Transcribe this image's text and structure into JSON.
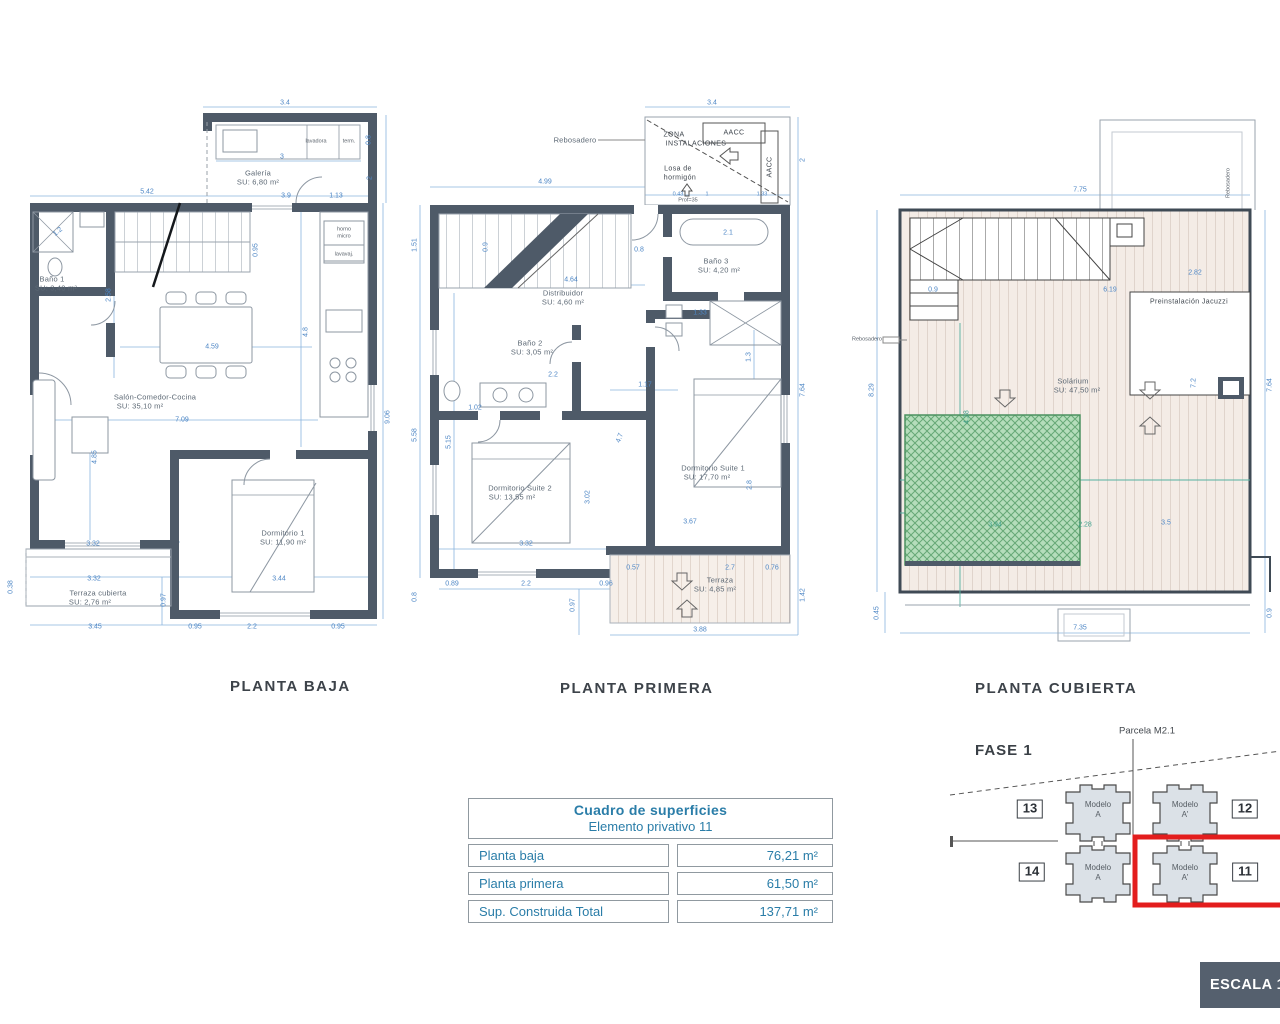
{
  "plans": {
    "baja": {
      "title": "PLANTA BAJA",
      "labels": [
        {
          "t": "3.4",
          "x": 265,
          "y": 8
        },
        {
          "t": "0.8",
          "x": 349,
          "y": 45,
          "r": -90
        },
        {
          "t": "3",
          "x": 262,
          "y": 62
        },
        {
          "t": "5.42",
          "x": 127,
          "y": 97
        },
        {
          "t": "3.9",
          "x": 266,
          "y": 101
        },
        {
          "t": "1.13",
          "x": 316,
          "y": 101
        },
        {
          "t": "2",
          "x": 350,
          "y": 83,
          "r": -90
        },
        {
          "t": "1.2",
          "x": 38,
          "y": 137,
          "r": -40
        },
        {
          "t": "2.58",
          "x": 89,
          "y": 200,
          "r": -90
        },
        {
          "t": "0.95",
          "x": 236,
          "y": 155,
          "r": -90
        },
        {
          "t": "4.8",
          "x": 286,
          "y": 237,
          "r": -90
        },
        {
          "t": "4.59",
          "x": 192,
          "y": 252
        },
        {
          "t": "7.09",
          "x": 162,
          "y": 325
        },
        {
          "t": "9.06",
          "x": 368,
          "y": 322,
          "r": -90
        },
        {
          "t": "4.85",
          "x": 75,
          "y": 362,
          "r": -90
        },
        {
          "t": "3.32",
          "x": 73,
          "y": 449
        },
        {
          "t": "0.38",
          "x": -9,
          "y": 492,
          "r": -90
        },
        {
          "t": "3.32",
          "x": 74,
          "y": 484
        },
        {
          "t": "3.44",
          "x": 259,
          "y": 484
        },
        {
          "t": "0.97",
          "x": 144,
          "y": 505,
          "r": -90
        },
        {
          "t": "3.45",
          "x": 75,
          "y": 532
        },
        {
          "t": "0.95",
          "x": 175,
          "y": 532
        },
        {
          "t": "2.2",
          "x": 232,
          "y": 532
        },
        {
          "t": "0.95",
          "x": 318,
          "y": 532
        },
        {
          "t": "Galería",
          "x": 238,
          "y": 78,
          "c": "room"
        },
        {
          "t": "SU: 6,80 m²",
          "x": 238,
          "y": 87,
          "c": "room"
        },
        {
          "t": "Baño 1",
          "x": 32,
          "y": 184,
          "c": "room"
        },
        {
          "t": "SU: 3,40 m²",
          "x": 36,
          "y": 193,
          "c": "room"
        },
        {
          "t": "Salón-Comedor-Cocina",
          "x": 135,
          "y": 302,
          "c": "room"
        },
        {
          "t": "SU: 35,10 m²",
          "x": 120,
          "y": 311,
          "c": "room"
        },
        {
          "t": "Dormitorio 1",
          "x": 263,
          "y": 438,
          "c": "room"
        },
        {
          "t": "SU: 11,90 m²",
          "x": 263,
          "y": 447,
          "c": "room"
        },
        {
          "t": "Terraza cubierta",
          "x": 78,
          "y": 498,
          "c": "room"
        },
        {
          "t": "SU: 2,76 m²",
          "x": 70,
          "y": 507,
          "c": "room"
        },
        {
          "t": "lavadora",
          "x": 296,
          "y": 47,
          "c": "tiny"
        },
        {
          "t": "term.",
          "x": 329,
          "y": 47,
          "c": "tiny"
        },
        {
          "t": "horno",
          "x": 324,
          "y": 135,
          "c": "tiny"
        },
        {
          "t": "micro",
          "x": 324,
          "y": 142,
          "c": "tiny"
        },
        {
          "t": "lavavaj.",
          "x": 324,
          "y": 160,
          "c": "tiny"
        }
      ]
    },
    "primera": {
      "title": "PLANTA PRIMERA",
      "labels": [
        {
          "t": "3.4",
          "x": 292,
          "y": 8
        },
        {
          "t": "4.99",
          "x": 125,
          "y": 87
        },
        {
          "t": "0.43",
          "x": 258,
          "y": 100,
          "c": "dimt"
        },
        {
          "t": "1",
          "x": 287,
          "y": 100,
          "c": "dimt"
        },
        {
          "t": "1.33",
          "x": 342,
          "y": 100,
          "c": "dimt"
        },
        {
          "t": "2",
          "x": 383,
          "y": 65,
          "r": -90
        },
        {
          "t": "1.51",
          "x": -5,
          "y": 150,
          "r": -90
        },
        {
          "t": "0.9",
          "x": 66,
          "y": 152,
          "r": -90
        },
        {
          "t": "0.8",
          "x": 219,
          "y": 155
        },
        {
          "t": "2.1",
          "x": 308,
          "y": 138
        },
        {
          "t": "4.64",
          "x": 151,
          "y": 185
        },
        {
          "t": "1.33",
          "x": 280,
          "y": 218
        },
        {
          "t": "1.3",
          "x": 329,
          "y": 262,
          "r": -90
        },
        {
          "t": "7.64",
          "x": 383,
          "y": 295,
          "r": -90
        },
        {
          "t": "1.17",
          "x": 225,
          "y": 290
        },
        {
          "t": "1.02",
          "x": 55,
          "y": 313
        },
        {
          "t": "5.58",
          "x": -5,
          "y": 340,
          "r": -90
        },
        {
          "t": "5.15",
          "x": 29,
          "y": 347,
          "r": -90
        },
        {
          "t": "4.7",
          "x": 200,
          "y": 343,
          "r": -70
        },
        {
          "t": "3.02",
          "x": 168,
          "y": 402,
          "r": -90
        },
        {
          "t": "2.8",
          "x": 330,
          "y": 390,
          "r": -90
        },
        {
          "t": "3.67",
          "x": 270,
          "y": 427
        },
        {
          "t": "3.32",
          "x": 106,
          "y": 449
        },
        {
          "t": "0.57",
          "x": 213,
          "y": 473
        },
        {
          "t": "2.7",
          "x": 310,
          "y": 473
        },
        {
          "t": "0.76",
          "x": 352,
          "y": 473
        },
        {
          "t": "0.89",
          "x": 32,
          "y": 489
        },
        {
          "t": "2.2",
          "x": 106,
          "y": 489
        },
        {
          "t": "0.96",
          "x": 186,
          "y": 489
        },
        {
          "t": "0.8",
          "x": -5,
          "y": 502,
          "r": -90
        },
        {
          "t": "0.97",
          "x": 153,
          "y": 510,
          "r": -90
        },
        {
          "t": "3.88",
          "x": 280,
          "y": 535
        },
        {
          "t": "1.42",
          "x": 383,
          "y": 500,
          "r": -90
        },
        {
          "t": "Rebosadero",
          "x": 155,
          "y": 45,
          "c": "room"
        },
        {
          "t": "ZONA",
          "x": 254,
          "y": 40,
          "c": "dark"
        },
        {
          "t": "INSTALACIONES",
          "x": 276,
          "y": 49,
          "c": "dark"
        },
        {
          "t": "AACC",
          "x": 314,
          "y": 38,
          "c": "dark"
        },
        {
          "t": "AACC",
          "x": 350,
          "y": 72,
          "r": -90,
          "c": "dark"
        },
        {
          "t": "Losa de",
          "x": 258,
          "y": 74,
          "c": "dark"
        },
        {
          "t": "hormigón",
          "x": 260,
          "y": 83,
          "c": "dark"
        },
        {
          "t": "Prof=35",
          "x": 268,
          "y": 106,
          "c": "tiny"
        },
        {
          "t": "Baño 3",
          "x": 296,
          "y": 166,
          "c": "room"
        },
        {
          "t": "SU: 4,20 m²",
          "x": 299,
          "y": 175,
          "c": "room"
        },
        {
          "t": "Distribuidor",
          "x": 143,
          "y": 198,
          "c": "room"
        },
        {
          "t": "SU: 4,60 m²",
          "x": 143,
          "y": 207,
          "c": "room"
        },
        {
          "t": "Baño 2",
          "x": 110,
          "y": 248,
          "c": "room"
        },
        {
          "t": "SU: 3,05 m²",
          "x": 112,
          "y": 257,
          "c": "room"
        },
        {
          "t": "2.2",
          "x": 133,
          "y": 280
        },
        {
          "t": "Dormitorio Suite 2",
          "x": 100,
          "y": 393,
          "c": "room"
        },
        {
          "t": "SU: 13,55 m²",
          "x": 92,
          "y": 402,
          "c": "room"
        },
        {
          "t": "Dormitorio Suite 1",
          "x": 293,
          "y": 373,
          "c": "room"
        },
        {
          "t": "SU: 17,70 m²",
          "x": 287,
          "y": 382,
          "c": "room"
        },
        {
          "t": "Terraza",
          "x": 300,
          "y": 485,
          "c": "room"
        },
        {
          "t": "SU: 4,85 m²",
          "x": 295,
          "y": 494,
          "c": "room"
        }
      ]
    },
    "cubierta": {
      "title": "PLANTA CUBIERTA",
      "labels": [
        {
          "t": "7.75",
          "x": 225,
          "y": 95
        },
        {
          "t": "Rebosadero",
          "x": 374,
          "y": 88,
          "r": -90,
          "c": "tiny"
        },
        {
          "t": "2.82",
          "x": 340,
          "y": 178
        },
        {
          "t": "6.19",
          "x": 255,
          "y": 195
        },
        {
          "t": "0.9",
          "x": 78,
          "y": 195
        },
        {
          "t": "Preinstalación Jacuzzi",
          "x": 334,
          "y": 207,
          "c": "dark"
        },
        {
          "t": "Rebosadero",
          "x": 12,
          "y": 245,
          "c": "tiny"
        },
        {
          "t": "8.29",
          "x": 17,
          "y": 295,
          "r": -90
        },
        {
          "t": "7.64",
          "x": 415,
          "y": 290,
          "r": -90
        },
        {
          "t": "7.2",
          "x": 339,
          "y": 288,
          "r": -90
        },
        {
          "t": "Solárium",
          "x": 218,
          "y": 286,
          "c": "room"
        },
        {
          "t": "SU: 47,50 m²",
          "x": 222,
          "y": 295,
          "c": "room"
        },
        {
          "t": "4.28",
          "x": 112,
          "y": 322,
          "r": -90,
          "c": "teal"
        },
        {
          "t": "3.94",
          "x": 140,
          "y": 430,
          "c": "teal"
        },
        {
          "t": "2.28",
          "x": 230,
          "y": 430,
          "c": "teal"
        },
        {
          "t": "3.5",
          "x": 311,
          "y": 428
        },
        {
          "t": "0.45",
          "x": 22,
          "y": 518,
          "r": -90
        },
        {
          "t": "0.9",
          "x": 415,
          "y": 518,
          "r": -90
        },
        {
          "t": "7.35",
          "x": 225,
          "y": 533
        }
      ]
    }
  },
  "table": {
    "title": "Cuadro de superficies",
    "subtitle": "Elemento privativo 11",
    "rows": [
      {
        "label": "Planta baja",
        "value": "76,21 m²"
      },
      {
        "label": "Planta primera",
        "value": "61,50 m²"
      },
      {
        "label": "Sup. Construida Total",
        "value": "137,71 m²"
      }
    ]
  },
  "site": {
    "fase": "FASE 1",
    "parcela": "Parcela M2.1",
    "highlight_color": "#e31d1d",
    "units": [
      {
        "number": "13",
        "model": "Modelo",
        "variant": "A"
      },
      {
        "number": "12",
        "model": "Modelo",
        "variant": "A'"
      },
      {
        "number": "14",
        "model": "Modelo",
        "variant": "A"
      },
      {
        "number": "11",
        "model": "Modelo",
        "variant": "A'",
        "highlighted": true
      }
    ]
  },
  "scale": {
    "label": "ESCALA 1/7"
  }
}
